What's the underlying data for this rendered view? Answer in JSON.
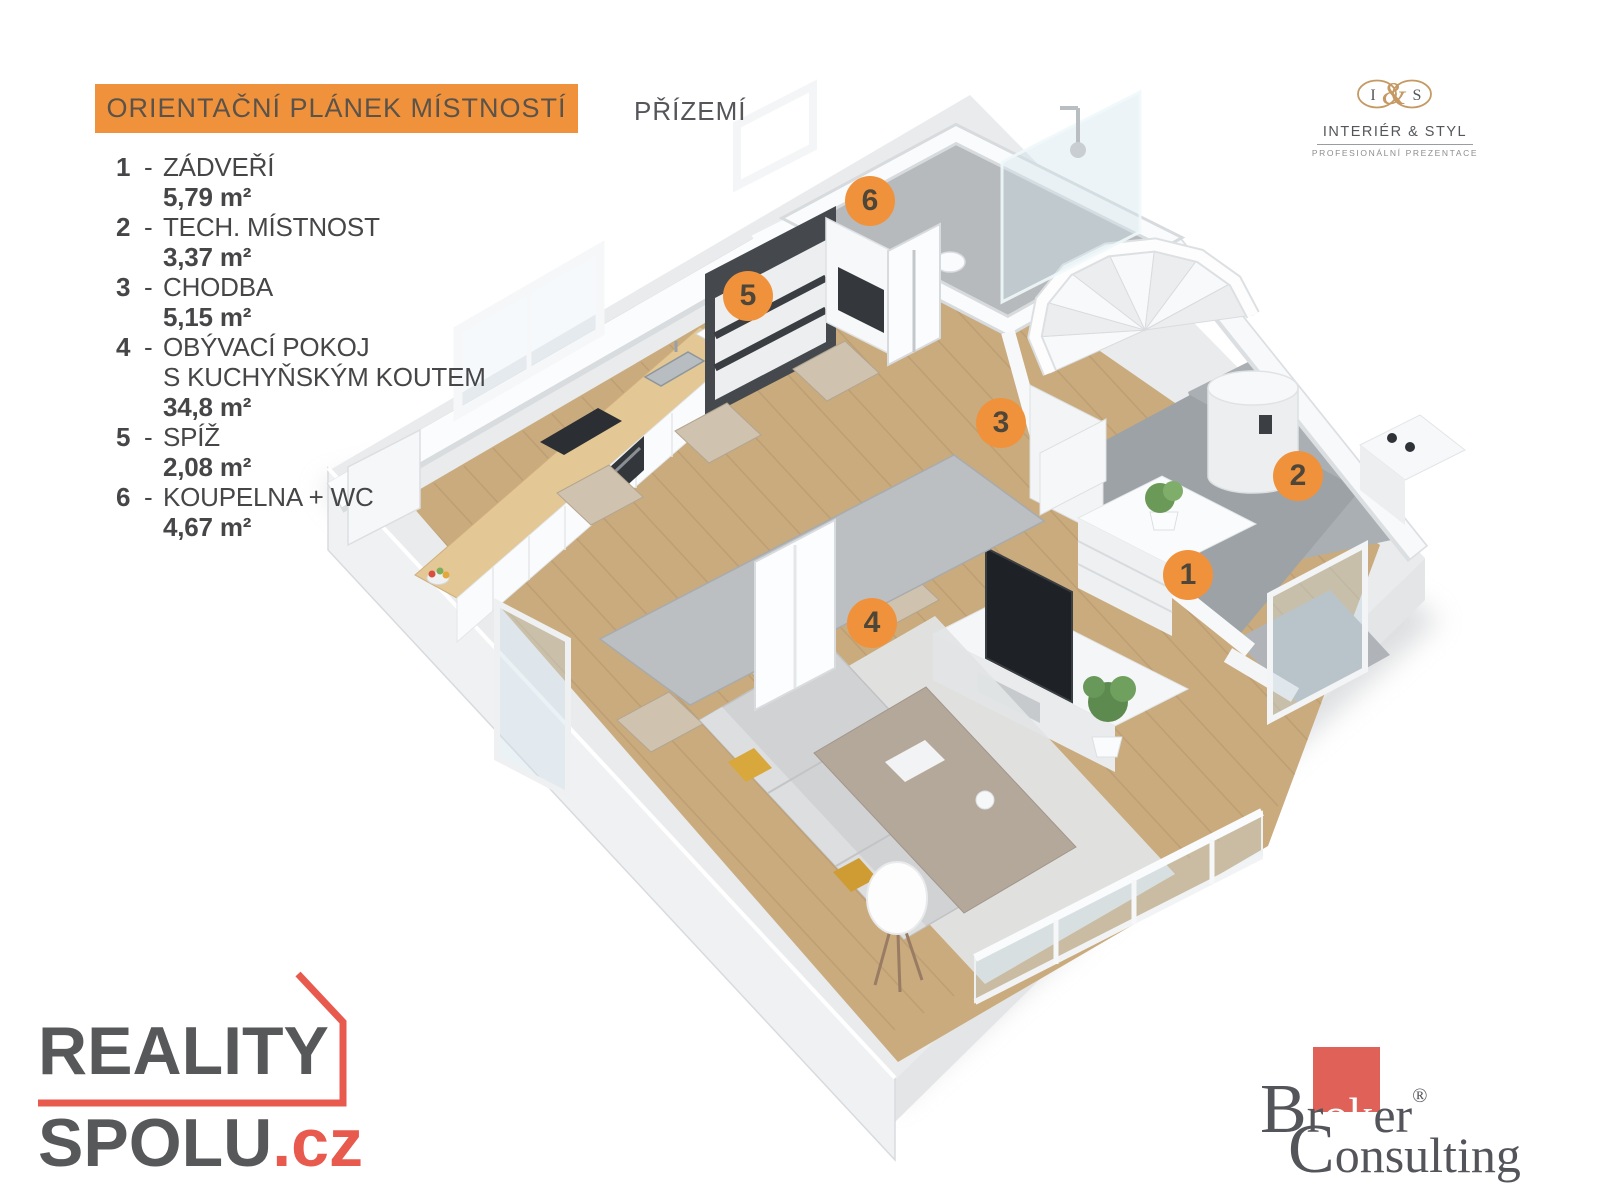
{
  "header": {
    "title": "ORIENTAČNÍ PLÁNEK MÍSTNOSTÍ",
    "floor_label": "PŘÍZEMÍ"
  },
  "legend": {
    "items": [
      {
        "num": "1",
        "dash": "-",
        "name": "ZÁDVEŘÍ",
        "name2": "",
        "area": "5,79 m²"
      },
      {
        "num": "2",
        "dash": "-",
        "name": "TECH. MÍSTNOST",
        "name2": "",
        "area": "3,37 m²"
      },
      {
        "num": "3",
        "dash": "-",
        "name": "CHODBA",
        "name2": "",
        "area": "5,15 m²"
      },
      {
        "num": "4",
        "dash": "-",
        "name": "OBÝVACÍ POKOJ",
        "name2": "S KUCHYŇSKÝM KOUTEM",
        "area": "34,8 m²"
      },
      {
        "num": "5",
        "dash": "-",
        "name": "SPÍŽ",
        "name2": "",
        "area": "2,08 m²"
      },
      {
        "num": "6",
        "dash": "-",
        "name": "KOUPELNA + WC",
        "name2": "",
        "area": "4,67 m²"
      }
    ]
  },
  "markers": [
    {
      "num": "1"
    },
    {
      "num": "2"
    },
    {
      "num": "3"
    },
    {
      "num": "4"
    },
    {
      "num": "5"
    },
    {
      "num": "6"
    }
  ],
  "logos": {
    "interier_styl": {
      "monogram_i": "I",
      "monogram_amp": "&",
      "monogram_s": "S",
      "name": "INTERIÉR & STYL",
      "tagline": "PROFESIONÁLNÍ PREZENTACE"
    },
    "reality_spolu": {
      "word1": "REALITY",
      "word2": "SPOLU",
      "suffix": ".cz"
    },
    "broker_consulting": {
      "p1": "B",
      "p2": "r",
      "p3": "ok",
      "p4": "er",
      "reg": "®",
      "c1": "C",
      "c2": "onsulting"
    }
  },
  "colors": {
    "accent_orange": "#F0923B",
    "marker_number": "#4D4639",
    "logo_red": "#E85A4E",
    "broker_red": "#DF6158",
    "gold": "#C49963",
    "text_dark": "#4E4E50",
    "wood_floor": "#C9AB7E",
    "tile_gray": "#9DA2A6"
  }
}
